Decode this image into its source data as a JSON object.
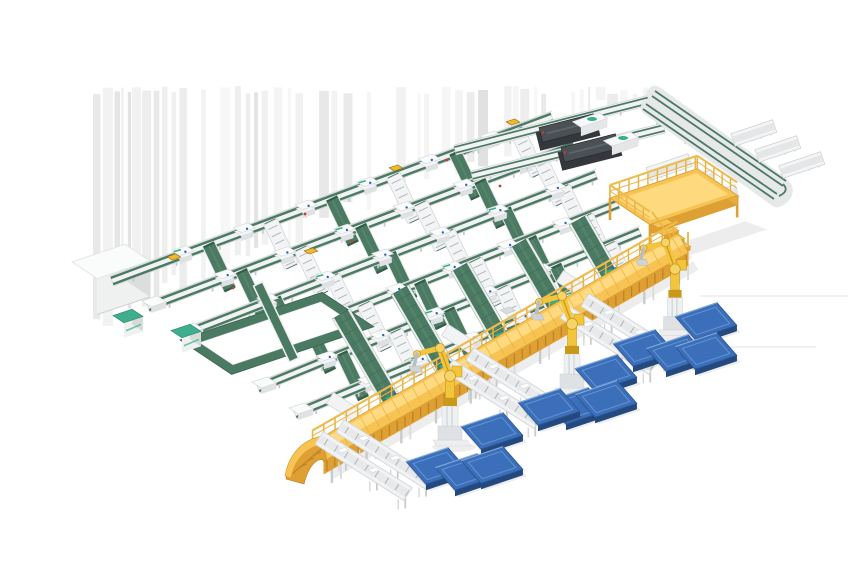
{
  "scene": {
    "width": 860,
    "height": 580,
    "background": "#ffffff",
    "description": "Isometric 3D render of an automated parcel sortation and palletizing line: green belt conveyor grid with induct stations, yellow elevated walkway with curved ramp, palletizing robots, blue pallets, output loop conveyor with discharge trays, mezzanine platform and labeling machines"
  },
  "palette": {
    "frame": "#f1f2f3",
    "frame_edge": "#d2d5d7",
    "frame_inner": "#e4e6e8",
    "leg_gray": "#c8cbcd",
    "slat": "#b3b8bb",
    "belt_green": "#4b7a63",
    "belt_green_dark": "#335c49",
    "belt_light": "#5d8a72",
    "teal": "#35b089",
    "cabinet_teal": "#3fae8f",
    "cabinet_teal_dark": "#2e8a70",
    "walk_top": "#f7c453",
    "walk_top_hi": "#ffdd85",
    "walk_side": "#dfa033",
    "walk_rib": "#c08428",
    "railing": "#e9b445",
    "railing_hi": "#edbc4f",
    "robot_yellow": "#f3c53d",
    "robot_dark": "#c9991c",
    "robot_joint": "#f6d469",
    "pallet_top": "#3b6fba",
    "pallet_side": "#24497f",
    "pallet_line": "#6493d1",
    "pallet_hi": "#7fa9dc",
    "machine_dark": "#34383c",
    "machine_top": "#4a5054",
    "machine_sheen": "#5d646a",
    "white_hi": "#fafbfb",
    "dot_red": "#c63d2f",
    "dot_blue": "#2563c4",
    "tote_yellow": "#f2b829",
    "tote_edge": "#8a6a14",
    "shadow": "rgba(0,0,0,0.07)",
    "stripe_grays": [
      "#ebebeb",
      "#e1e1e1",
      "#d8d8d8"
    ]
  },
  "basis": {
    "e": [
      0.948,
      -0.318
    ],
    "s": [
      0.832,
      0.555
    ]
  },
  "artifacts": {
    "stripes": {
      "x0": 93,
      "x1": 652,
      "y_top": 86,
      "seed": 7
    },
    "h_lines": [
      [
        700,
        296,
        848,
        296
      ],
      [
        678,
        347,
        816,
        347
      ]
    ]
  },
  "grid": {
    "lines": [
      [
        112,
        281,
        552,
        117
      ],
      [
        148,
        307,
        574,
        146
      ],
      [
        185,
        334,
        596,
        175
      ],
      [
        222,
        361,
        618,
        204
      ],
      [
        258,
        388,
        640,
        232
      ],
      [
        295,
        414,
        662,
        261
      ]
    ],
    "line_w": 10,
    "station_ts": [
      0.16,
      0.3,
      0.44,
      0.58,
      0.72,
      0.86
    ],
    "belt_ts": [
      0.22,
      0.36,
      0.5,
      0.64,
      0.78,
      0.92
    ],
    "roller_ts": [
      0.29,
      0.57,
      0.85
    ],
    "belt_vec": [
      21,
      44
    ],
    "belt_w": 13,
    "roller_w": 15
  },
  "declines": {
    "w": 20,
    "lanes": [
      [
        341,
        314,
        391,
        400
      ],
      [
        400,
        290,
        445,
        368
      ],
      [
        460,
        267,
        500,
        337
      ],
      [
        519,
        243,
        555,
        305
      ],
      [
        578,
        220,
        609,
        274
      ]
    ]
  },
  "walkway": {
    "line": [
      318,
      452,
      683,
      243
    ],
    "half_w": 11,
    "side_h": 13,
    "ramp_tip": [
      286,
      479
    ]
  },
  "spurs": {
    "dir": [
      0.845,
      0.535
    ],
    "len": 105,
    "w": 15,
    "pairs": [
      [
        340,
        426
      ],
      [
        470,
        354
      ],
      [
        585,
        300
      ]
    ],
    "pair_offset": [
      -20.8,
      11.9
    ],
    "stubs": [
      [
        330,
        398
      ],
      [
        445,
        330
      ],
      [
        560,
        276
      ]
    ]
  },
  "robots": [
    [
      450,
      438,
      1
    ],
    [
      572,
      386,
      1
    ],
    [
      675,
      328,
      0.95
    ]
  ],
  "pallets": [
    [
      492,
      431
    ],
    [
      437,
      466
    ],
    [
      466,
      472
    ],
    [
      492,
      465
    ],
    [
      606,
      373
    ],
    [
      577,
      406
    ],
    [
      606,
      399
    ],
    [
      549,
      407
    ],
    [
      706,
      321
    ],
    [
      644,
      348
    ],
    [
      677,
      353
    ],
    [
      706,
      351
    ]
  ],
  "loop": {
    "bands": [
      [
        655,
        94,
        786,
        184
      ],
      [
        643,
        106,
        774,
        196
      ]
    ],
    "tray_len": 44,
    "tray_w": 13,
    "trays_left": [
      [
        690,
        160
      ],
      [
        713,
        176
      ],
      [
        737,
        191
      ]
    ],
    "trays_right": [
      [
        733,
        140
      ],
      [
        757,
        156
      ],
      [
        781,
        172
      ]
    ]
  },
  "collectors": [
    [
      455,
      150,
      650,
      100
    ],
    [
      472,
      176,
      664,
      128
    ]
  ],
  "machines": [
    {
      "c": [
        568,
        134
      ]
    },
    {
      "c": [
        590,
        154
      ]
    }
  ],
  "housings": [
    {
      "c": [
        590,
        120
      ]
    },
    {
      "c": [
        621,
        139
      ]
    }
  ],
  "mezzanine": {
    "origin": [
      610,
      198
    ],
    "e_len": 92,
    "s_len": 48,
    "stairs_at": [
      652,
      224
    ]
  },
  "ring": {
    "origin": [
      180,
      340
    ],
    "e_len": 150,
    "s_len": 62,
    "bar": 11,
    "cross_from": [
      258,
      284
    ],
    "cross_to": [
      294,
      360
    ]
  },
  "cabinets": [
    [
      128,
      316
    ],
    [
      186,
      331
    ]
  ],
  "white_box": {
    "origin": [
      72,
      262
    ],
    "e_len": 56,
    "s_len": 30,
    "h": 36
  },
  "totes": [
    [
      513,
      122
    ],
    [
      396,
      168
    ],
    [
      174,
      257
    ],
    [
      311,
      251
    ]
  ],
  "red_dots": [
    [
      305,
      214
    ],
    [
      352,
      241
    ],
    [
      447,
      160
    ],
    [
      500,
      186
    ],
    [
      233,
      288
    ],
    [
      410,
      300
    ]
  ]
}
